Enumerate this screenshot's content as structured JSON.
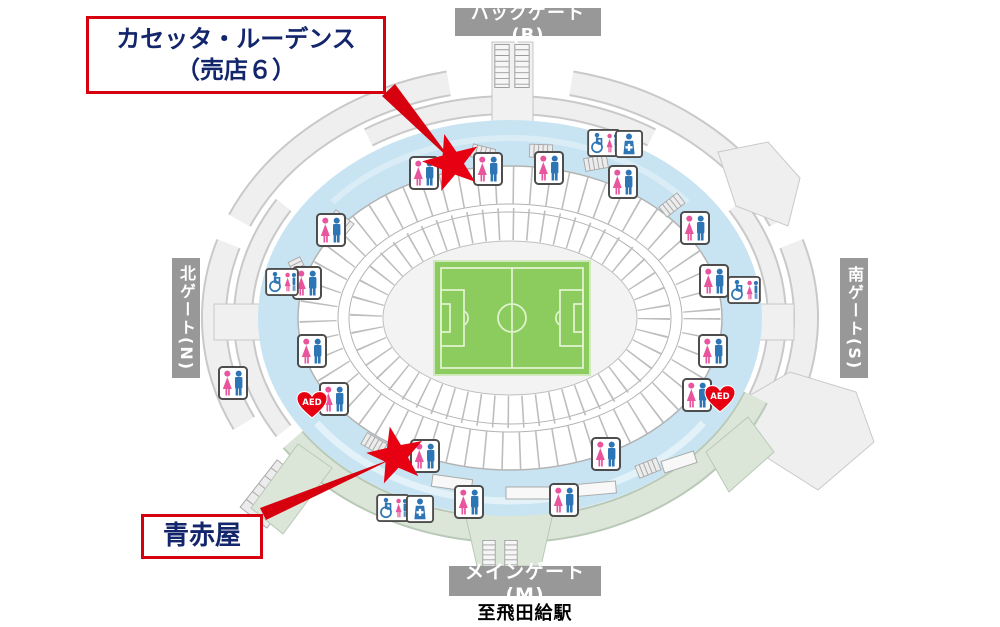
{
  "callouts": {
    "shop": {
      "line1": "カセッタ・ルーデンス",
      "line2": "（売店６）"
    },
    "aoakaya": {
      "label": "青赤屋"
    }
  },
  "gates": {
    "back": {
      "label": "バックゲート(B)"
    },
    "north": {
      "label": "北ゲート(N)"
    },
    "south": {
      "label": "南ゲート(S)"
    },
    "main": {
      "label": "メインゲート(M)"
    }
  },
  "station": {
    "label": "至飛田給駅"
  },
  "map": {
    "aed_label": "AED",
    "colors": {
      "accent_red": "#d7000f",
      "star": "#e60012",
      "navy_text": "#13266b",
      "gate_bg": "#989898",
      "concourse_blue": "#c8e4f2",
      "walkway_green": "#dbe6d8",
      "pitch_green": "#8ccb5e",
      "female_icon": "#e8559d",
      "male_icon": "#2e75b6"
    },
    "icons": {
      "toilet": "toilet-icon",
      "accessible_toilet": "accessible-toilet-icon",
      "first_aid": "first-aid-icon",
      "aed": "aed-icon",
      "star_marker": "star-marker",
      "stairs": "stairs-icon"
    }
  }
}
